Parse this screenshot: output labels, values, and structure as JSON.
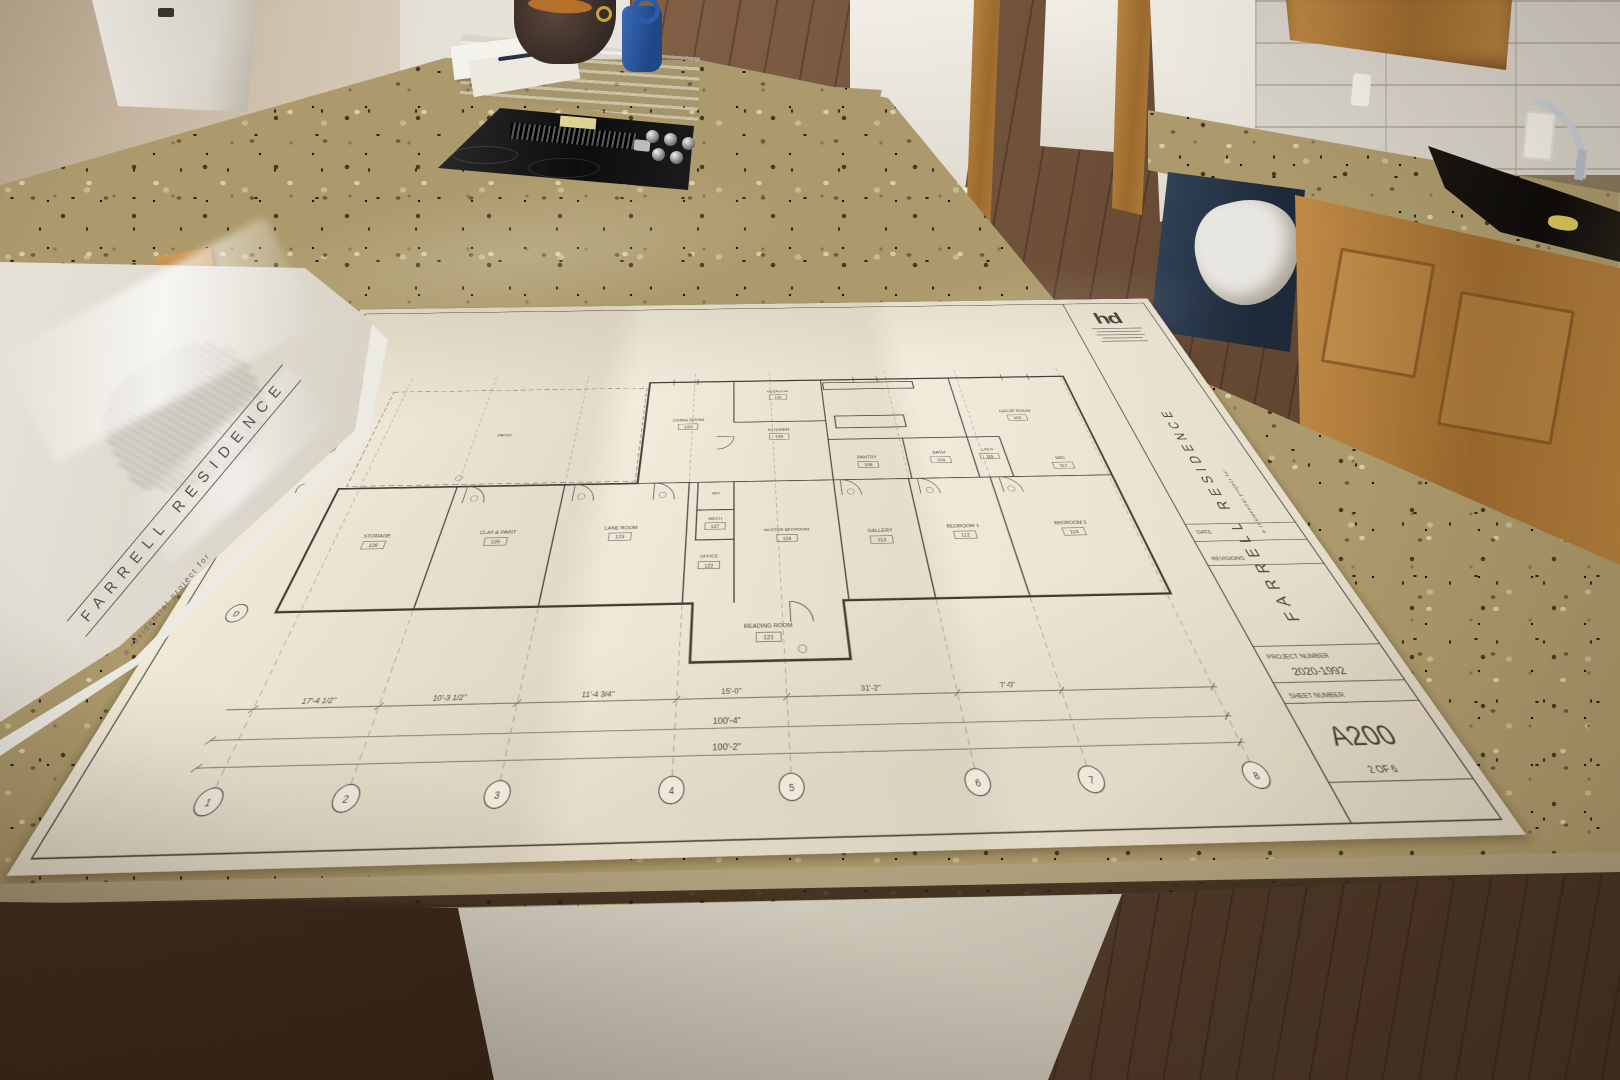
{
  "scene": {
    "setting": "new-construction kitchen with granite island",
    "subject": "architectural floor plan blueprints spread on countertop"
  },
  "cover_sheet": {
    "title": "FARRELL RESIDENCE",
    "subtitle": "a residential project for"
  },
  "sheet": {
    "logo_text": "hd",
    "side_title": "FARRELL RESIDENCE",
    "side_subtitle": "a residential project for",
    "title_block": {
      "date_label": "DATE",
      "revisions_label": "REVISIONS",
      "project_number_label": "PROJECT NUMBER",
      "project_number_value": "2020-1992",
      "sheet_number_label": "SHEET NUMBER",
      "sheet_number_value": "A200",
      "sheet_count": "2 OF 6"
    },
    "rooms": [
      {
        "name": "PATIO",
        "num": ""
      },
      {
        "name": "LIVING ROOM",
        "num": "100"
      },
      {
        "name": "KITCHEN",
        "num": "105"
      },
      {
        "name": "PANTRY",
        "num": "108"
      },
      {
        "name": "GREAT ROOM",
        "num": "103"
      },
      {
        "name": "BATH",
        "num": "104"
      },
      {
        "name": "LINEN",
        "num": "115"
      },
      {
        "name": "WIC",
        "num": "117"
      },
      {
        "name": "WH",
        "num": ""
      },
      {
        "name": "MECH",
        "num": "127"
      },
      {
        "name": "STORAGE",
        "num": "126"
      },
      {
        "name": "CLAY & PAINT",
        "num": "125"
      },
      {
        "name": "LANE ROOM",
        "num": "123"
      },
      {
        "name": "OFFICE",
        "num": "122"
      },
      {
        "name": "MASTER BEDROOM",
        "num": "119"
      },
      {
        "name": "GALLERY",
        "num": "113"
      },
      {
        "name": "BEDROOM 1",
        "num": "112"
      },
      {
        "name": "BEDROOM 2",
        "num": "114"
      },
      {
        "name": "READING ROOM",
        "num": "121"
      },
      {
        "name": "MUDROOM",
        "num": "109"
      }
    ],
    "dimensions": {
      "overall_top": "100'-4\"",
      "overall_bottom": "100'-2\"",
      "seg1": "17'-4 1/2\"",
      "seg2": "10'-3 1/2\"",
      "seg3": "11'-4 3/4\"",
      "seg4": "15'-0\"",
      "seg5": "31'-2\"",
      "seg6": "7'-0\""
    },
    "grid_numbers": [
      "1",
      "2",
      "3",
      "4",
      "5",
      "6",
      "7",
      "8"
    ],
    "grid_letters": [
      "A",
      "B",
      "C",
      "D"
    ]
  },
  "colors": {
    "granite": "#ac9a6c",
    "cabinet_wood": "#b5813e",
    "floor_wood": "#74523a",
    "dishwasher_front": "#2c3a4c",
    "paper": "#f0ead9",
    "drafting_ink": "#45403a",
    "bottle_blue": "#2d5ca6"
  }
}
